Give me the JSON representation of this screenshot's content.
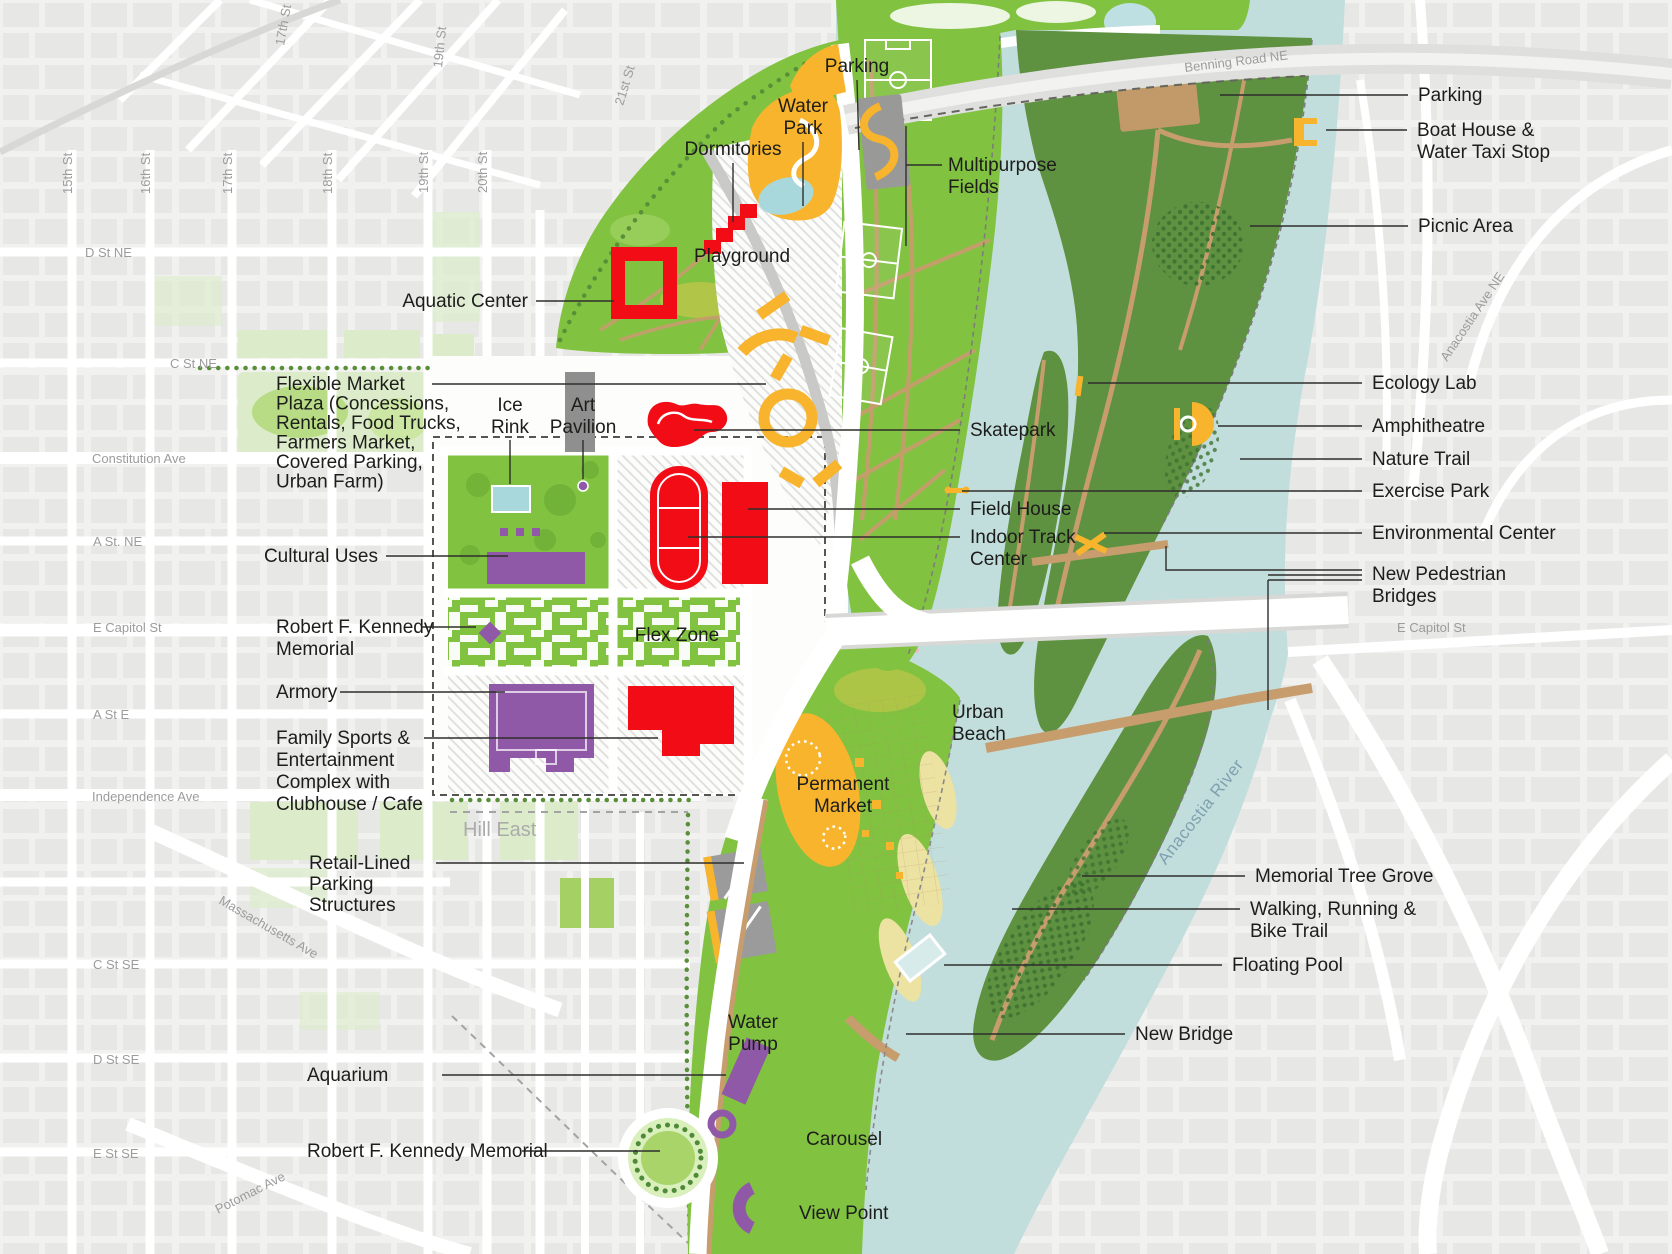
{
  "map_title": "RFK site and Anacostia River plan",
  "colors": {
    "park_green": "#82c241",
    "woodland_green": "#5e9140",
    "water": "#c2dedc",
    "feature_red": "#f20d16",
    "civic_purple": "#9059a8",
    "activity_orange": "#f7b42c",
    "path_tan": "#c79d6e",
    "sand": "#ece2a2",
    "city_block_gray": "#e7e7e6",
    "label_black": "#1d1d1b",
    "street_gray": "#9c9c9c",
    "river_label_blue": "#7fa0b0"
  },
  "icons": {
    "boat-house-icon": "#f7b42c",
    "amphitheatre-icon": "#f7b42c",
    "ecology-lab-icon": "#f7b42c",
    "environmental-center-icon": "#f7b42c",
    "exercise-park-icon": "#f7b42c",
    "carousel-icon": "#9059a8",
    "view-point-icon": "#9059a8",
    "rfk-memorial-diamond-icon": "#9059a8",
    "art-pavilion-dot-icon": "#9059a8",
    "floating-pool-icon": "#d7ecea"
  },
  "callouts": [
    {
      "id": "parking-north",
      "lines": [
        "Parking"
      ],
      "x": 857,
      "y": 72,
      "anchor": "middle",
      "leaders": [
        [
          [
            857,
            80
          ],
          [
            859,
            150
          ]
        ]
      ]
    },
    {
      "id": "water-park",
      "lines": [
        "Water",
        "Park"
      ],
      "x": 803,
      "y": 112,
      "anchor": "middle",
      "lh": 22,
      "leaders": [
        [
          [
            803,
            142
          ],
          [
            803,
            206
          ]
        ]
      ]
    },
    {
      "id": "dormitories",
      "lines": [
        "Dormitories"
      ],
      "x": 733,
      "y": 155,
      "anchor": "middle",
      "leaders": [
        [
          [
            733,
            163
          ],
          [
            733,
            222
          ]
        ]
      ]
    },
    {
      "id": "playground",
      "lines": [
        "Playground"
      ],
      "x": 742,
      "y": 262,
      "anchor": "middle"
    },
    {
      "id": "aquatic-center",
      "lines": [
        "Aquatic Center"
      ],
      "x": 528,
      "y": 307,
      "anchor": "end",
      "leaders": [
        [
          [
            536,
            301
          ],
          [
            614,
            301
          ]
        ]
      ]
    },
    {
      "id": "multipurpose-fields",
      "lines": [
        "Multipurpose",
        "Fields"
      ],
      "x": 948,
      "y": 171,
      "lh": 22,
      "leaders": [
        [
          [
            942,
            165
          ],
          [
            906,
            165
          ]
        ],
        [
          [
            906,
            126
          ],
          [
            906,
            246
          ]
        ]
      ]
    },
    {
      "id": "parking-east",
      "lines": [
        "Parking"
      ],
      "x": 1418,
      "y": 101,
      "leaders": [
        [
          [
            1408,
            95
          ],
          [
            1220,
            95
          ]
        ]
      ]
    },
    {
      "id": "boat-house",
      "lines": [
        "Boat House &",
        "Water Taxi Stop"
      ],
      "x": 1417,
      "y": 136,
      "lh": 22,
      "leaders": [
        [
          [
            1407,
            130
          ],
          [
            1326,
            130
          ]
        ]
      ]
    },
    {
      "id": "picnic-area",
      "lines": [
        "Picnic Area"
      ],
      "x": 1418,
      "y": 232,
      "leaders": [
        [
          [
            1408,
            226
          ],
          [
            1250,
            226
          ]
        ]
      ]
    },
    {
      "id": "ecology-lab",
      "lines": [
        "Ecology Lab"
      ],
      "x": 1372,
      "y": 389,
      "leaders": [
        [
          [
            1362,
            383
          ],
          [
            1088,
            383
          ]
        ]
      ]
    },
    {
      "id": "amphitheatre",
      "lines": [
        "Amphitheatre"
      ],
      "x": 1372,
      "y": 432,
      "leaders": [
        [
          [
            1362,
            426
          ],
          [
            1218,
            426
          ]
        ]
      ]
    },
    {
      "id": "nature-trail",
      "lines": [
        "Nature Trail"
      ],
      "x": 1372,
      "y": 465,
      "leaders": [
        [
          [
            1362,
            459
          ],
          [
            1240,
            459
          ]
        ]
      ]
    },
    {
      "id": "exercise-park",
      "lines": [
        "Exercise Park"
      ],
      "x": 1372,
      "y": 497,
      "leaders": [
        [
          [
            1362,
            491
          ],
          [
            962,
            491
          ]
        ]
      ]
    },
    {
      "id": "environmental-center",
      "lines": [
        "Environmental Center"
      ],
      "x": 1372,
      "y": 539,
      "leaders": [
        [
          [
            1362,
            533
          ],
          [
            1104,
            533
          ]
        ]
      ]
    },
    {
      "id": "new-pedestrian-bridges",
      "lines": [
        "New Pedestrian",
        "Bridges"
      ],
      "x": 1372,
      "y": 580,
      "lh": 22,
      "leaders": [
        [
          [
            1362,
            570
          ],
          [
            1268,
            570
          ]
        ],
        [
          [
            1362,
            575
          ],
          [
            1268,
            575
          ]
        ],
        [
          [
            1362,
            580
          ],
          [
            1268,
            580
          ]
        ],
        [
          [
            1268,
            580
          ],
          [
            1268,
            710
          ]
        ],
        [
          [
            1268,
            570
          ],
          [
            1166,
            570
          ],
          [
            1166,
            546
          ]
        ]
      ]
    },
    {
      "id": "flexible-market-plaza",
      "lines": [
        "Flexible Market",
        "Plaza (Concessions,",
        "Rentals, Food Trucks,",
        "Farmers Market,",
        "Covered Parking,",
        "Urban Farm)"
      ],
      "x": 276,
      "y": 390,
      "lh": 19.5,
      "leaders": [
        [
          [
            432,
            384
          ],
          [
            766,
            384
          ]
        ]
      ]
    },
    {
      "id": "ice-rink",
      "lines": [
        "Ice",
        "Rink"
      ],
      "x": 510,
      "y": 411,
      "anchor": "middle",
      "lh": 22,
      "leaders": [
        [
          [
            510,
            440
          ],
          [
            510,
            484
          ]
        ]
      ]
    },
    {
      "id": "art-pavilion",
      "lines": [
        "Art",
        "Pavilion"
      ],
      "x": 583,
      "y": 411,
      "anchor": "middle",
      "lh": 22,
      "leaders": [
        [
          [
            583,
            440
          ],
          [
            583,
            479
          ]
        ]
      ]
    },
    {
      "id": "skatepark",
      "lines": [
        "Skatepark"
      ],
      "x": 970,
      "y": 436,
      "leaders": [
        [
          [
            960,
            430
          ],
          [
            694,
            430
          ]
        ]
      ]
    },
    {
      "id": "cultural-uses",
      "lines": [
        "Cultural Uses"
      ],
      "x": 378,
      "y": 562,
      "anchor": "end",
      "leaders": [
        [
          [
            386,
            556
          ],
          [
            508,
            556
          ]
        ]
      ]
    },
    {
      "id": "field-house",
      "lines": [
        "Field House"
      ],
      "x": 970,
      "y": 515,
      "leaders": [
        [
          [
            960,
            509
          ],
          [
            748,
            509
          ]
        ]
      ]
    },
    {
      "id": "indoor-track-center",
      "lines": [
        "Indoor Track",
        "Center"
      ],
      "x": 970,
      "y": 543,
      "lh": 22,
      "leaders": [
        [
          [
            960,
            537
          ],
          [
            688,
            537
          ]
        ]
      ]
    },
    {
      "id": "rfk-memorial-north",
      "lines": [
        "Robert F. Kennedy",
        "Memorial"
      ],
      "x": 276,
      "y": 633,
      "lh": 22,
      "leaders": [
        [
          [
            422,
            627
          ],
          [
            476,
            627
          ]
        ]
      ]
    },
    {
      "id": "flex-zone",
      "lines": [
        "Flex Zone"
      ],
      "x": 677,
      "y": 641,
      "anchor": "middle"
    },
    {
      "id": "armory",
      "lines": [
        "Armory"
      ],
      "x": 276,
      "y": 698,
      "leaders": [
        [
          [
            340,
            692
          ],
          [
            505,
            692
          ]
        ]
      ]
    },
    {
      "id": "family-sports",
      "lines": [
        "Family Sports &",
        "Entertainment",
        "Complex with",
        "Clubhouse / Cafe"
      ],
      "x": 276,
      "y": 744,
      "lh": 22,
      "leaders": [
        [
          [
            424,
            738
          ],
          [
            658,
            738
          ]
        ]
      ]
    },
    {
      "id": "urban-beach",
      "lines": [
        "Urban",
        "Beach"
      ],
      "x": 952,
      "y": 718,
      "lh": 22
    },
    {
      "id": "permanent-market",
      "lines": [
        "Permanent",
        "Market"
      ],
      "x": 843,
      "y": 790,
      "anchor": "middle",
      "lh": 22
    },
    {
      "id": "retail-parking",
      "lines": [
        "Retail-Lined",
        "Parking",
        "Structures"
      ],
      "x": 309,
      "y": 869,
      "lh": 21,
      "leaders": [
        [
          [
            436,
            863
          ],
          [
            744,
            863
          ]
        ]
      ]
    },
    {
      "id": "aquarium",
      "lines": [
        "Aquarium"
      ],
      "x": 307,
      "y": 1081,
      "leaders": [
        [
          [
            442,
            1075
          ],
          [
            726,
            1075
          ]
        ]
      ]
    },
    {
      "id": "rfk-memorial-south",
      "lines": [
        "Robert F. Kennedy Memorial"
      ],
      "x": 307,
      "y": 1157,
      "leaders": [
        [
          [
            522,
            1151
          ],
          [
            660,
            1151
          ]
        ]
      ]
    },
    {
      "id": "water-pump",
      "lines": [
        "Water",
        "Pump"
      ],
      "x": 753,
      "y": 1028,
      "anchor": "middle",
      "lh": 22
    },
    {
      "id": "carousel",
      "lines": [
        "Carousel"
      ],
      "x": 806,
      "y": 1145
    },
    {
      "id": "view-point",
      "lines": [
        "View Point"
      ],
      "x": 799,
      "y": 1219
    },
    {
      "id": "new-bridge",
      "lines": [
        "New Bridge"
      ],
      "x": 1135,
      "y": 1040,
      "leaders": [
        [
          [
            1125,
            1034
          ],
          [
            906,
            1034
          ]
        ]
      ]
    },
    {
      "id": "memorial-tree-grove",
      "lines": [
        "Memorial Tree Grove"
      ],
      "x": 1255,
      "y": 882,
      "leaders": [
        [
          [
            1245,
            876
          ],
          [
            1082,
            876
          ]
        ]
      ]
    },
    {
      "id": "walking-trail",
      "lines": [
        "Walking, Running &",
        "Bike Trail"
      ],
      "x": 1250,
      "y": 915,
      "lh": 22,
      "leaders": [
        [
          [
            1240,
            909
          ],
          [
            1012,
            909
          ]
        ]
      ]
    },
    {
      "id": "floating-pool",
      "lines": [
        "Floating Pool"
      ],
      "x": 1232,
      "y": 971,
      "leaders": [
        [
          [
            1222,
            965
          ],
          [
            944,
            965
          ]
        ]
      ]
    }
  ],
  "street_labels": [
    {
      "text": "15th St",
      "x": 72,
      "y": 194,
      "rotate": -90
    },
    {
      "text": "16th St",
      "x": 150,
      "y": 194,
      "rotate": -90
    },
    {
      "text": "17th St",
      "x": 232,
      "y": 194,
      "rotate": -90
    },
    {
      "text": "18th St",
      "x": 332,
      "y": 194,
      "rotate": -90
    },
    {
      "text": "19th St",
      "x": 428,
      "y": 193,
      "rotate": -90
    },
    {
      "text": "20th St",
      "x": 487,
      "y": 193,
      "rotate": -90
    },
    {
      "text": "21st St",
      "x": 623,
      "y": 106,
      "rotate": -73
    },
    {
      "text": "17th St",
      "x": 284,
      "y": 46,
      "rotate": -80
    },
    {
      "text": "19th St",
      "x": 442,
      "y": 68,
      "rotate": -84
    },
    {
      "text": "D St NE",
      "x": 85,
      "y": 257
    },
    {
      "text": "C St NE",
      "x": 170,
      "y": 368
    },
    {
      "text": "Constitution Ave",
      "x": 92,
      "y": 463
    },
    {
      "text": "A St. NE",
      "x": 93,
      "y": 546
    },
    {
      "text": "E Capitol St",
      "x": 93,
      "y": 632
    },
    {
      "text": "A St E",
      "x": 93,
      "y": 719
    },
    {
      "text": "Independence Ave",
      "x": 92,
      "y": 801
    },
    {
      "text": "Massachusetts Ave",
      "x": 218,
      "y": 903,
      "rotate": 30
    },
    {
      "text": "C St SE",
      "x": 93,
      "y": 969
    },
    {
      "text": "D St SE",
      "x": 93,
      "y": 1064
    },
    {
      "text": "E St SE",
      "x": 93,
      "y": 1158
    },
    {
      "text": "Potomac Ave",
      "x": 218,
      "y": 1214,
      "rotate": -27
    },
    {
      "text": "Benning Road NE",
      "x": 1185,
      "y": 72,
      "rotate": -7
    },
    {
      "text": "Anacostia Ave NE",
      "x": 1447,
      "y": 362,
      "rotate": -56
    },
    {
      "text": "E Capitol St",
      "x": 1397,
      "y": 632
    }
  ],
  "area_labels": [
    {
      "text": "Anacostia River",
      "x": 1205,
      "y": 815,
      "rotate": -52,
      "class": "water-label",
      "anchor": "middle"
    },
    {
      "text": "Hill East",
      "x": 463,
      "y": 836,
      "class": "district"
    }
  ]
}
